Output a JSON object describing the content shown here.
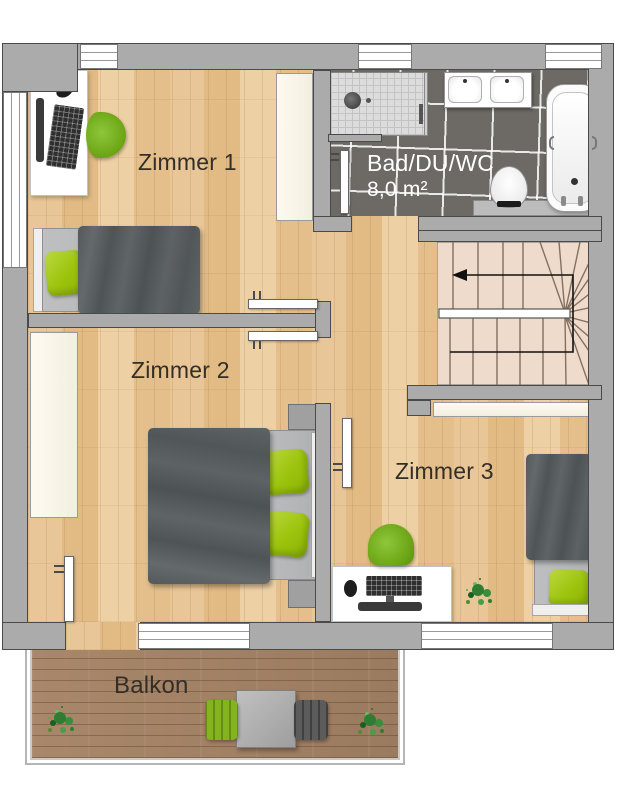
{
  "plan_title": "Obergeschoss Grundriss",
  "rooms": [
    {
      "id": "zimmer1",
      "name": "Zimmer 1"
    },
    {
      "id": "zimmer2",
      "name": "Zimmer 2"
    },
    {
      "id": "zimmer3",
      "name": "Zimmer 3"
    },
    {
      "id": "bad",
      "name": "Bad/DU/WC",
      "area": "8,0 m²"
    },
    {
      "id": "balkon",
      "name": "Balkon"
    }
  ],
  "palette": {
    "wall": "#ababab",
    "wallb": "#4a4a4a",
    "wood": "#e6c191",
    "deck": "#a28266",
    "tile": "#6d6965",
    "stair": "#eedbcb",
    "pillow-green": "#9cc40d",
    "chair-green": "#6aa313",
    "blanket-gray": "#585d5f",
    "label": "#332e28"
  }
}
